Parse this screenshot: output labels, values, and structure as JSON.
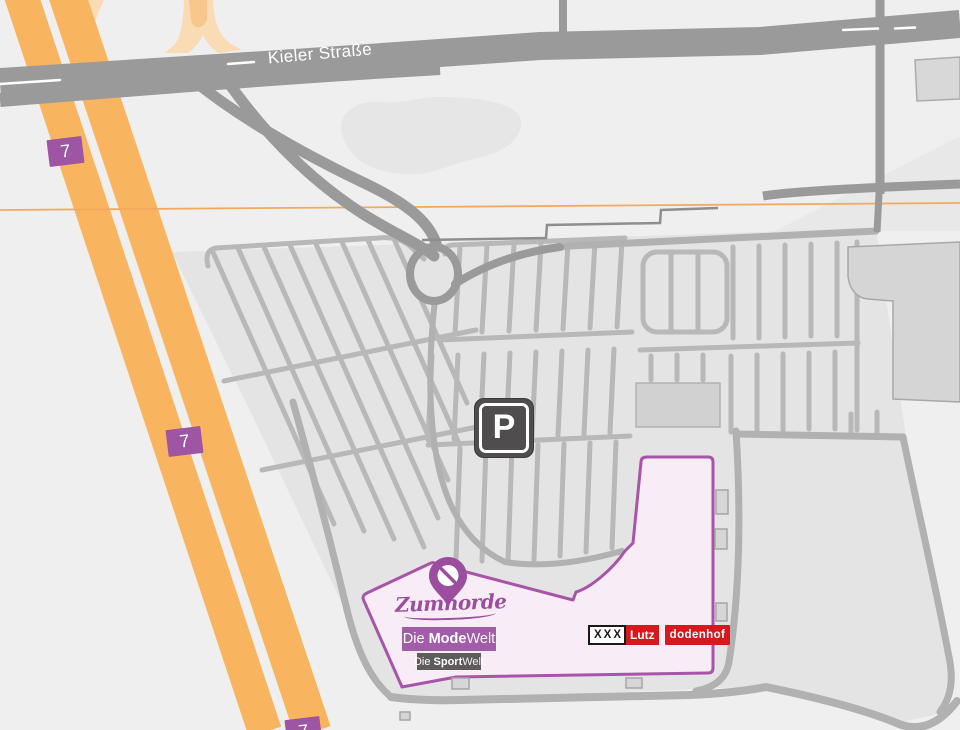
{
  "roads": {
    "main_label": "Kieler Straße"
  },
  "highway": {
    "badge": "7"
  },
  "parking": {
    "symbol": "P"
  },
  "store": {
    "brand": "Zumnorde",
    "mode_prefix": "Die ",
    "mode_bold": "Mode",
    "mode_suffix": "Welt",
    "sport_prefix": "Die ",
    "sport_bold": "Sport",
    "sport_suffix": "Welt"
  },
  "logos": {
    "xxx": "XXX",
    "lutz": "Lutz",
    "dodenhof": "dodenhof"
  },
  "colors": {
    "accent_purple": "#9c4d9f",
    "badge_purple": "#9d55a4",
    "highway_orange": "#f9b45f",
    "ramp_peach": "#f9dcb4",
    "road_gray": "#9b9a9a",
    "parking_fill": "#e5e4e5",
    "building_pink": "#f8ecf6",
    "building_outline": "#a854a8",
    "logo_red": "#d6181f",
    "sign_dark": "#4f4d4e"
  }
}
